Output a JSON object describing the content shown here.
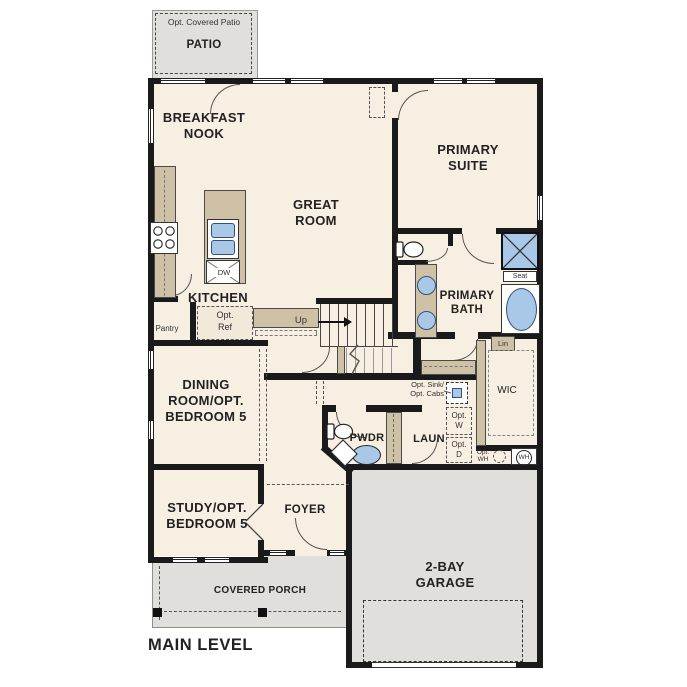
{
  "colors": {
    "wall": "#1a1a1a",
    "floor": "#f7efe1",
    "gray": "#e0dfdb",
    "tan": "#cfc1a5",
    "fixture_blue": "#a9c7e6"
  },
  "plan": {
    "title": "MAIN LEVEL",
    "patio": {
      "opt": "Opt. Covered Patio",
      "label": "PATIO"
    },
    "rooms": {
      "breakfast_nook": "BREAKFAST\nNOOK",
      "great_room": "GREAT\nROOM",
      "primary_suite": "PRIMARY\nSUITE",
      "kitchen": "KITCHEN",
      "primary_bath": "PRIMARY\nBATH",
      "dining": "DINING\nROOM/OPT.\nBEDROOM 5",
      "study": "STUDY/OPT.\nBEDROOM 5",
      "foyer": "FOYER",
      "pwdr": "PWDR",
      "laundry": "LAUN",
      "wic": "WIC",
      "garage": "2-BAY\nGARAGE",
      "porch": "COVERED PORCH"
    },
    "annotations": {
      "pantry": "Pantry",
      "opt_ref": "Opt.\nRef",
      "dw": "DW",
      "up": "Up",
      "seat": "Seat",
      "lin": "Lin",
      "opt_sink": "Opt. Sink/\nOpt. Cabs",
      "opt_w": "Opt.\nW",
      "opt_d": "Opt.\nD",
      "opt_wh": "Opt.\nWH",
      "wh": "WH"
    }
  }
}
